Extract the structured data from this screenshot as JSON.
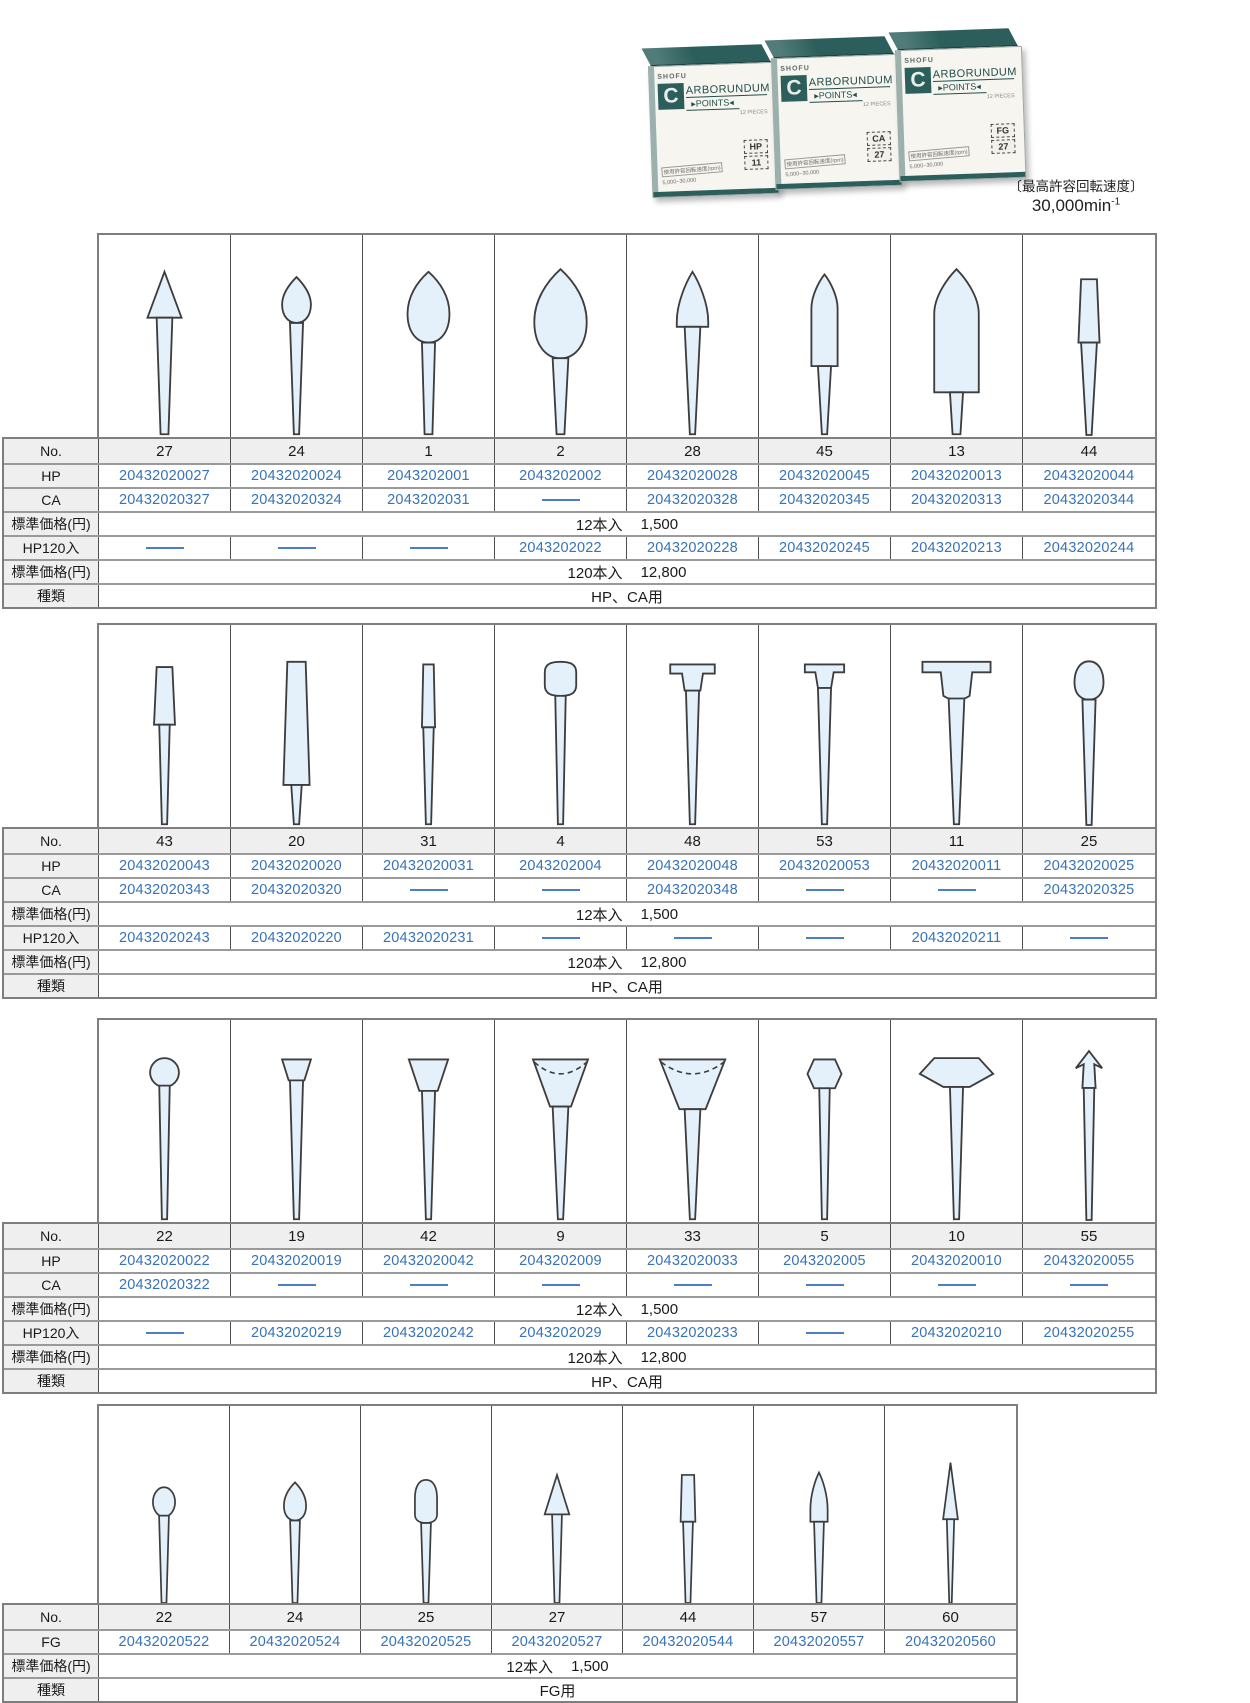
{
  "header": {
    "max_speed_caption": "〔最高許容回転速度〕",
    "max_speed_value": "30,000min",
    "max_speed_exp": "-1"
  },
  "boxes": {
    "brand": "SHOFU",
    "logo_letter": "C",
    "title1": "ARBORUNDUM",
    "title2": "▸POINTS◂",
    "pieces": "12 PIECES",
    "usage1": "使用許容回転速度(rpm)",
    "usage2": "5,000~30,000",
    "labels": [
      {
        "type": "HP",
        "no": "11"
      },
      {
        "type": "CA",
        "no": "27"
      },
      {
        "type": "FG",
        "no": "27"
      }
    ]
  },
  "labels": {
    "no": "No.",
    "hp": "HP",
    "ca": "CA",
    "fg": "FG",
    "hp120": "HP120入",
    "price": "標準価格(円)",
    "kind": "種類"
  },
  "accent_colors": {
    "link_blue": "#3673b8",
    "box_teal": "#2c5f5b",
    "shape_fill": "#e4f0fa",
    "row_gray": "#efefef"
  },
  "tables": [
    {
      "id": "t1",
      "price12": {
        "qty": "12本入",
        "price": "1,500"
      },
      "price120": {
        "qty": "120本入",
        "price": "12,800"
      },
      "kind": "HP、CA用",
      "row_order": [
        "no",
        "hp",
        "ca",
        "price12",
        "hp120",
        "price120",
        "kind"
      ],
      "columns": [
        {
          "no": "27",
          "shape": "cone-point",
          "hp": "20432020027",
          "ca": "20432020327",
          "hp120": ""
        },
        {
          "no": "24",
          "shape": "bud-small",
          "hp": "20432020024",
          "ca": "20432020324",
          "hp120": ""
        },
        {
          "no": "1",
          "shape": "teardrop-medium",
          "hp": "2043202001",
          "ca": "2043202031",
          "hp120": ""
        },
        {
          "no": "2",
          "shape": "teardrop-large",
          "hp": "2043202002",
          "ca": "",
          "hp120": "2043202022"
        },
        {
          "no": "28",
          "shape": "flame",
          "hp": "20432020028",
          "ca": "20432020328",
          "hp120": "20432020228"
        },
        {
          "no": "45",
          "shape": "bullet-slim",
          "hp": "20432020045",
          "ca": "20432020345",
          "hp120": "20432020245"
        },
        {
          "no": "13",
          "shape": "bullet-large",
          "hp": "20432020013",
          "ca": "20432020313",
          "hp120": "20432020213"
        },
        {
          "no": "44",
          "shape": "taper-cylinder",
          "hp": "20432020044",
          "ca": "20432020344",
          "hp120": "20432020244"
        }
      ]
    },
    {
      "id": "t2",
      "price12": {
        "qty": "12本入",
        "price": "1,500"
      },
      "price120": {
        "qty": "120本入",
        "price": "12,800"
      },
      "kind": "HP、CA用",
      "row_order": [
        "no",
        "hp",
        "ca",
        "price12",
        "hp120",
        "price120",
        "kind"
      ],
      "columns": [
        {
          "no": "43",
          "shape": "taper-small",
          "hp": "20432020043",
          "ca": "20432020343",
          "hp120": "20432020243"
        },
        {
          "no": "20",
          "shape": "taper-long",
          "hp": "20432020020",
          "ca": "20432020320",
          "hp120": "20432020220"
        },
        {
          "no": "31",
          "shape": "cylinder-thin",
          "hp": "20432020031",
          "ca": "",
          "hp120": "20432020231"
        },
        {
          "no": "4",
          "shape": "knob-wheel",
          "hp": "2043202004",
          "ca": "",
          "hp120": ""
        },
        {
          "no": "48",
          "shape": "t-head-small",
          "hp": "20432020048",
          "ca": "20432020348",
          "hp120": ""
        },
        {
          "no": "53",
          "shape": "t-head-small2",
          "hp": "20432020053",
          "ca": "",
          "hp120": ""
        },
        {
          "no": "11",
          "shape": "t-head-wide",
          "hp": "20432020011",
          "ca": "",
          "hp120": "20432020211"
        },
        {
          "no": "25",
          "shape": "bud-round",
          "hp": "20432020025",
          "ca": "20432020325",
          "hp120": ""
        }
      ]
    },
    {
      "id": "t3",
      "price12": {
        "qty": "12本入",
        "price": "1,500"
      },
      "price120": {
        "qty": "120本入",
        "price": "12,800"
      },
      "kind": "HP、CA用",
      "row_order": [
        "no",
        "hp",
        "ca",
        "price12",
        "hp120",
        "price120",
        "kind"
      ],
      "columns": [
        {
          "no": "22",
          "shape": "ball",
          "hp": "20432020022",
          "ca": "20432020322",
          "hp120": ""
        },
        {
          "no": "19",
          "shape": "cup-small",
          "hp": "20432020019",
          "ca": "",
          "hp120": "20432020219"
        },
        {
          "no": "42",
          "shape": "cup-medium",
          "hp": "20432020042",
          "ca": "",
          "hp120": "20432020242"
        },
        {
          "no": "9",
          "shape": "cup-large",
          "hp": "2043202009",
          "ca": "",
          "hp120": "2043202029"
        },
        {
          "no": "33",
          "shape": "cup-xlarge",
          "hp": "20432020033",
          "ca": "",
          "hp120": "20432020233"
        },
        {
          "no": "5",
          "shape": "hex-barrel",
          "hp": "2043202005",
          "ca": "",
          "hp120": ""
        },
        {
          "no": "10",
          "shape": "wheel-pointed",
          "hp": "20432020010",
          "ca": "",
          "hp120": "20432020210"
        },
        {
          "no": "55",
          "shape": "spear",
          "hp": "20432020055",
          "ca": "",
          "hp120": "20432020255"
        }
      ]
    },
    {
      "id": "t4",
      "price12": {
        "qty": "12本入",
        "price": "1,500"
      },
      "kind": "FG用",
      "row_order": [
        "no",
        "fg",
        "price12",
        "kind"
      ],
      "columns": [
        {
          "no": "22",
          "shape": "ball-small",
          "fg": "20432020522"
        },
        {
          "no": "24",
          "shape": "flame-small",
          "fg": "20432020524"
        },
        {
          "no": "25",
          "shape": "oval-bud",
          "fg": "20432020525"
        },
        {
          "no": "27",
          "shape": "cone-small",
          "fg": "20432020527"
        },
        {
          "no": "44",
          "shape": "taper-cyl-small",
          "fg": "20432020544"
        },
        {
          "no": "57",
          "shape": "flame-slim",
          "fg": "20432020557"
        },
        {
          "no": "60",
          "shape": "needle",
          "fg": "20432020560"
        }
      ]
    }
  ]
}
